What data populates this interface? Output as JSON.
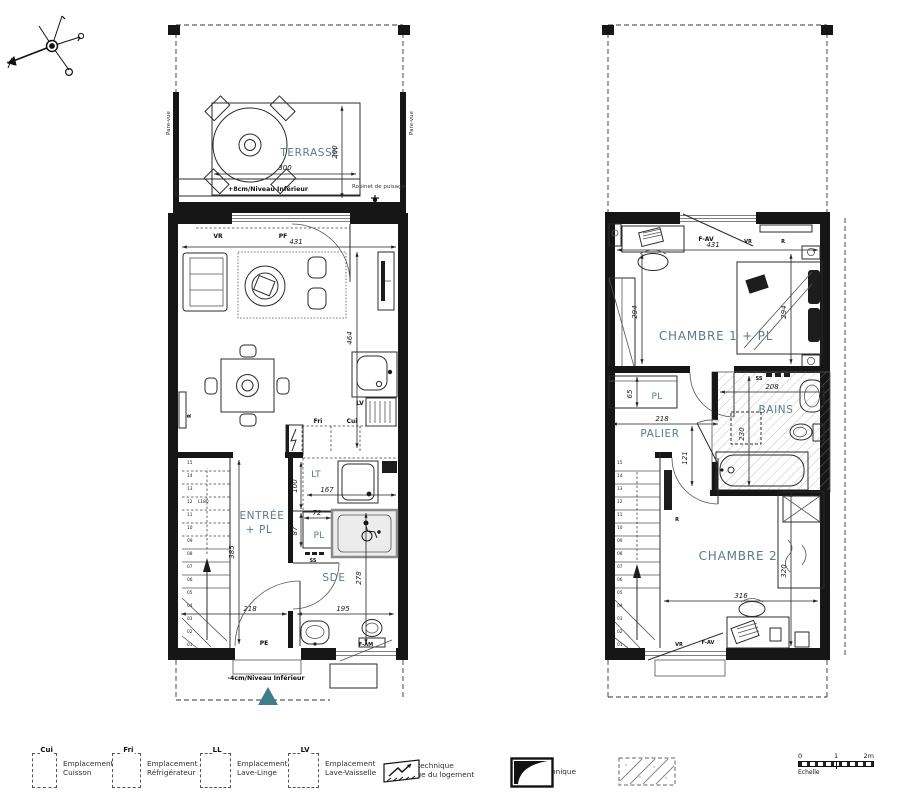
{
  "colors": {
    "label": "#5d7a88",
    "accent": "#3e7d8b",
    "line": "#1c1c1c"
  },
  "ground_floor": {
    "terrace": {
      "label": "TERRASSE",
      "dim_w": "300",
      "dim_h": "200",
      "level_note": "+8cm/Niveau Inférieur",
      "pare_vue": "Pare-vue",
      "tap": "Robinet de puisage"
    },
    "sejour": {
      "label": "SÉJOUR - CUISINE",
      "dim_w": "431",
      "dim_h": "464",
      "vr": "VR",
      "pf": "PF",
      "radiator": "R"
    },
    "kitchen": {
      "fri": "Fri",
      "cui": "Cui",
      "lv": "LV"
    },
    "lt": {
      "label": "LT",
      "dim_h": "100",
      "dim_w": "167"
    },
    "pl": {
      "label": "PL",
      "dim_w": "72",
      "dim_h": "87",
      "ss": "SS"
    },
    "entree": {
      "label_line1": "ENTRÉE",
      "label_line2": "+ PL",
      "dim_h": "385",
      "dim_w": "218",
      "stair_note": "L180"
    },
    "sde": {
      "label": "SDE",
      "dim_h": "278",
      "dim_w": "195",
      "window": "F-AM"
    },
    "entrance_door": "PE",
    "level_note": "-4cm/Niveau Inférieur"
  },
  "upper_floor": {
    "chambre1": {
      "label": "CHAMBRE 1 + PL",
      "dim_w": "431",
      "dim_h": "294",
      "window": "F-AV",
      "vr": "VR",
      "radiator": "R"
    },
    "pl": {
      "label": "PL",
      "dim": "65"
    },
    "palier": {
      "label": "PALIER",
      "dim_w": "218",
      "dim_h": "121"
    },
    "bains": {
      "label": "BAINS",
      "dim_w": "208",
      "dim_h": "230",
      "ss": "SS"
    },
    "chambre2": {
      "label": "CHAMBRE 2",
      "dim_w": "316",
      "dim_h": "320",
      "window": "F-AV",
      "vr": "VR",
      "radiator": "R"
    }
  },
  "stairs": {
    "numbers": [
      "01",
      "02",
      "03",
      "04",
      "05",
      "06",
      "07",
      "08",
      "09",
      "10",
      "11",
      "12",
      "13",
      "14",
      "15"
    ]
  },
  "legend": {
    "items": [
      {
        "tag": "Cui",
        "line1": "Emplacement",
        "line2": "Cuisson"
      },
      {
        "tag": "Fri",
        "line1": "Emplacement",
        "line2": "Réfrigérateur"
      },
      {
        "tag": "LL",
        "line1": "Emplacement",
        "line2": "Lave-Linge"
      },
      {
        "tag": "LV",
        "line1": "Emplacement",
        "line2": "Lave-Vaisselle"
      }
    ],
    "electrical": {
      "line1": "Espace technique",
      "line2": "électrique du logement"
    },
    "gaine": {
      "label": "Gaine technique"
    },
    "faux_plafond": {
      "line1": "Faux-plafond",
      "line2": "Soffite"
    },
    "scale": {
      "t0": "0",
      "t1": "1",
      "t2": "2m",
      "label": "Echelle"
    }
  }
}
